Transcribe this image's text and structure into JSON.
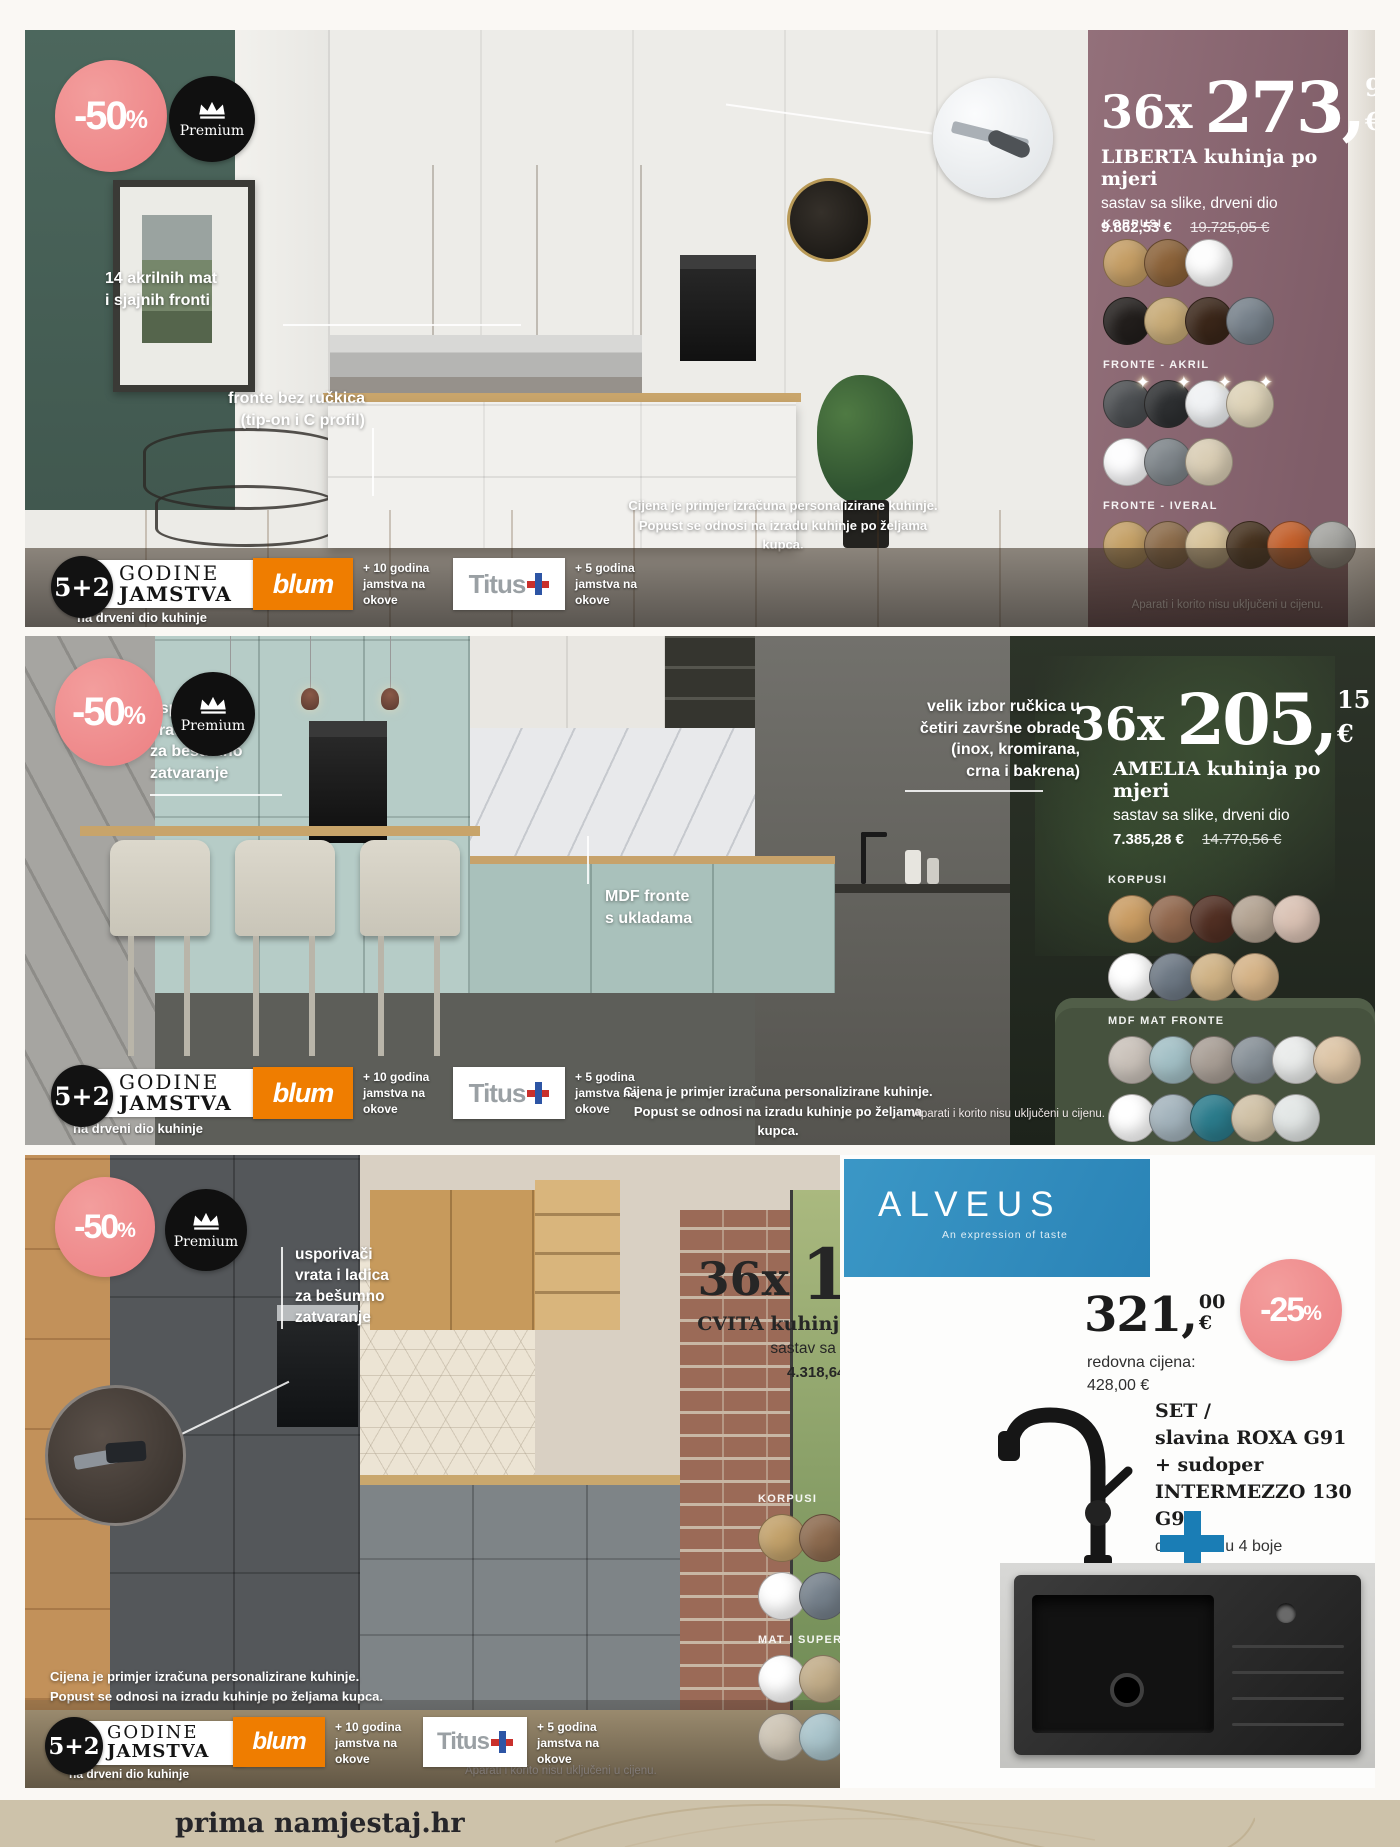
{
  "page": {
    "footer_brand": "prima namjestaj.hr"
  },
  "badges": {
    "discount_50": "-50",
    "discount_25": "-25",
    "percent": "%",
    "premium": "Premium"
  },
  "warranty": {
    "years": "5+2",
    "godine": "GODINE",
    "jamstva": "JAMSTVA",
    "wood_note": "na drveni dio kuhinje",
    "blum": "blum",
    "blum_note": [
      "+ 10 godina",
      "jamstva na",
      "okove"
    ],
    "titus": "Titus",
    "titus_note": [
      "+ 5 godina",
      "jamstva na",
      "okove"
    ]
  },
  "legal": {
    "price_example": [
      "Cijena je primjer izračuna personalizirane kuhinje.",
      "Popust se odnosi na izradu kuhinje po željama kupca."
    ],
    "appliances_note": "Aparati i korito nisu uključeni u cijenu."
  },
  "kitchens": {
    "liberta": {
      "installments": "36x",
      "price_int": "273,",
      "price_cents": "96",
      "currency": "€",
      "name": "LIBERTA kuhinja po mjeri",
      "detail": "sastav sa slike, drveni dio",
      "price_now": "9.862,53 €",
      "price_old": "19.725,05 €",
      "callout_fronts": [
        "14 akrilnih mat",
        "i sjajnih fronti"
      ],
      "callout_handles": [
        "fronte bez ručkica",
        "(tip-on i C profil)"
      ],
      "swatch_groups": [
        {
          "label": "KORPUSI",
          "rows": [
            [
              "#c49d64",
              "#8b6239",
              "#fdfdfd"
            ],
            [
              "#221e1c",
              "#c7aa76",
              "#3a2619",
              "#76808a"
            ]
          ]
        },
        {
          "label": "FRONTE - AKRIL",
          "sparkles": true,
          "rows": [
            [
              "#4b4e51",
              "#2d2f31",
              "#f0f2f4",
              "#ddd2b7"
            ],
            [
              "#fdfdfe",
              "#7d8489",
              "#d9cdb4"
            ]
          ]
        },
        {
          "label": "FRONTE - IVERAL",
          "rows": [
            [
              "#c4a066",
              "#8b6b4a",
              "#d6c299",
              "#45311e",
              "#c15e2a",
              "#a3a39f"
            ]
          ]
        }
      ]
    },
    "amelia": {
      "installments": "36x",
      "price_int": "205,",
      "price_cents": "15",
      "currency": "€",
      "name": "AMELIA kuhinja po mjeri",
      "detail": "sastav sa slike, drveni dio",
      "price_now": "7.385,28 €",
      "price_old": "14.770,56 €",
      "callout_dampers": [
        "usporivači",
        "vrata i ladica",
        "za bešumno",
        "zatvaranje"
      ],
      "callout_handles": [
        "velik izbor ručkica u",
        "četiri završne obrade",
        "(inox, kromirana,",
        "crna i bakrena)"
      ],
      "callout_mdf": [
        "MDF fronte",
        "s ukladama"
      ],
      "swatch_groups": [
        {
          "label": "KORPUSI",
          "rows": [
            [
              "#c99c63",
              "#91684e",
              "#512f23",
              "#b2a291",
              "#d9c1b3"
            ],
            [
              "#ffffff",
              "#6d7884",
              "#cfb285",
              "#d4b286"
            ]
          ]
        },
        {
          "label": "MDF MAT FRONTE",
          "rows": [
            [
              "#c9c1b9",
              "#a2bfc5",
              "#a89e95",
              "#879097",
              "#e9ebea",
              "#dcc4a5"
            ],
            [
              "#ffffff",
              "#a3b3bc",
              "#2b7b8b",
              "#cfc0a5",
              "#e2e6e5"
            ]
          ]
        }
      ]
    },
    "cvita": {
      "installments": "36x",
      "price_int": "119,",
      "price_cents": "96",
      "currency": "€",
      "name": "CVITA kuhinja po mjeri",
      "detail": "sastav sa slike, drveni dio",
      "price_now": "4.318,64 €",
      "price_old": "8.637,27 €",
      "callout_dampers": [
        "usporivači",
        "vrata i ladica",
        "za bešumno",
        "zatvaranje"
      ],
      "swatch_groups": [
        {
          "label": "KORPUSI",
          "rows": [
            [
              "#c2a16a",
              "#8c6a4e",
              "#40251b",
              "#b19f8b"
            ],
            [
              "#ffffff",
              "#75808b",
              "#c8b491",
              "#d2be99"
            ]
          ]
        },
        {
          "label": "MAT I SUPERMAT MDF FRONTE",
          "rows": [
            [
              "#ffffff",
              "#c1ac88",
              "#cbbc9f",
              "#a8b3c3",
              "#a5896e"
            ],
            [
              "#ccc3b3",
              "#a8c3ca",
              "#8cb795",
              "#2d3b63",
              "#6d7325"
            ]
          ]
        }
      ]
    }
  },
  "alveus": {
    "brand": "ALVEUS",
    "tagline": "An expression of taste",
    "price_int": "321,",
    "price_cents": "00",
    "currency": "€",
    "regular_price_label": "redovna cijena:",
    "regular_price": "428,00 €",
    "set_label": "SET /",
    "set_lines": [
      "slavina ROXA G91",
      "+ sudoper",
      "INTERMEZZO 130 G91"
    ],
    "colors_note": "dostupno u 4 boje"
  }
}
